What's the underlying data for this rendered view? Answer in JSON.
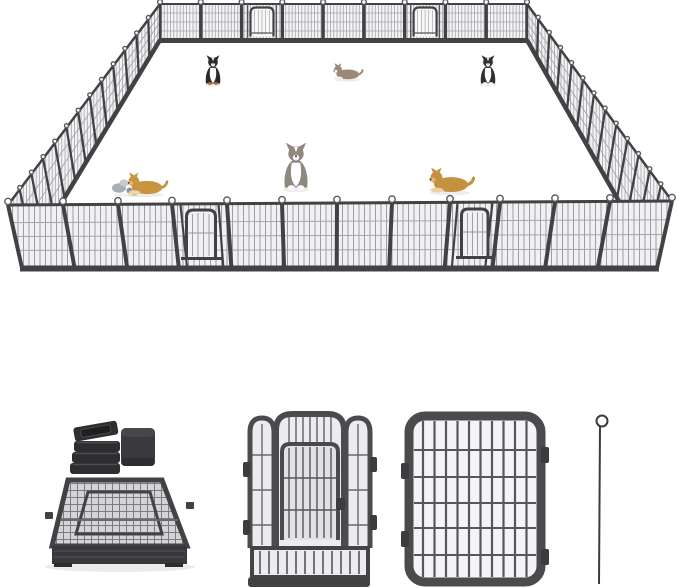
{
  "page": {
    "width": 679,
    "height": 588
  },
  "colors": {
    "page-bg": "#ffffff",
    "frame-dark": "#424245",
    "frame-mid": "#57575b",
    "mesh-line": "#9b9b9f",
    "mesh-fill": "#f3f3f5",
    "rail-light": "#a6a6aa",
    "loop-stroke": "#5a5a5e",
    "cap-black": "#2e2e31"
  },
  "playpen": {
    "description": "large rectangular heavy-duty metal dog playpen shown in perspective on white background",
    "walls": {
      "back": {
        "panels": 9,
        "door_panels": 2
      },
      "front": {
        "panels": 12,
        "door_panels": 2
      },
      "left": {
        "panels": 13,
        "door_panels": 0
      },
      "right": {
        "panels": 13,
        "door_panels": 0
      }
    },
    "features": [
      "arched walk-through doors",
      "loop stakes at panel joints",
      "dense vertical wire mesh panels"
    ]
  },
  "dogs": [
    {
      "breed": "bernese-mountain-dog",
      "pose": "sitting",
      "style": "--coat:#2d2926;--chest:#ffffff;--muzzle:#ffffff;--paw:#a9713c"
    },
    {
      "breed": "husky",
      "pose": "lying",
      "style": "--coat:#9b8977;--chest:#f4efe7;--muzzle:#f4efe7"
    },
    {
      "breed": "border-collie",
      "pose": "sitting",
      "style": "--coat:#32302d;--chest:#ffffff;--muzzle:#ffffff"
    },
    {
      "breed": "husky",
      "pose": "sitting",
      "style": "--coat:#8f887e;--chest:#ffffff;--muzzle:#ffffff"
    },
    {
      "breed": "golden-retriever",
      "pose": "lying",
      "style": "--coat:#c4913e;--chest:#ecd3a0;--muzzle:#e0b97a"
    },
    {
      "breed": "golden-retriever-puppy",
      "pose": "lying-with-toys",
      "style": "--coat:#c79440;--chest:#eed6a2;--muzzle:#e2bb7c"
    }
  ],
  "accessories": {
    "tube_caps": {
      "count": 4,
      "shape": "square black plastic end caps stacked"
    },
    "corner_cap": {
      "count": 1,
      "shape": "large rounded square black cap"
    },
    "folded_stack": "flat-folded panel stack for storage",
    "door_panel": "close-up of panel with arched walk-through door",
    "plain_panel": "close-up of standard wire panel with rounded corners",
    "ground_stake": "thin steel ground stake with loop handle"
  }
}
